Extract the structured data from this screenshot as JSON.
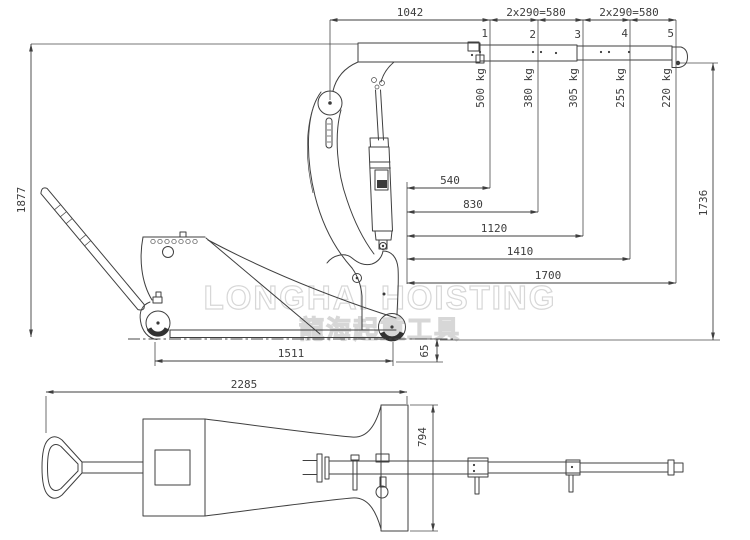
{
  "drawing": {
    "watermark": {
      "english": "LONGHAI HOISTING",
      "chinese": "龍海起重工具"
    },
    "colors": {
      "line": "#3f3f3f",
      "dim_text": "#3d3d3d",
      "watermark": "#d7d7d7",
      "background": "#ffffff",
      "wheel_fill": "#333333"
    },
    "side_view": {
      "boom_dims": {
        "base": "1042",
        "mid": "2x290=580",
        "outer": "2x290=580"
      },
      "hook_positions": [
        "1",
        "2",
        "3",
        "4",
        "5"
      ],
      "capacities": [
        "500 kg",
        "380 kg",
        "305 kg",
        "255 kg",
        "220 kg"
      ],
      "reach_dims": [
        "540",
        "830",
        "1120",
        "1410",
        "1700"
      ],
      "overall_height": "1877",
      "hook_height": "1736",
      "wheelbase": "1511",
      "rear_offset": "65"
    },
    "plan_view": {
      "overall_length": "2285",
      "overall_width": "794"
    }
  }
}
